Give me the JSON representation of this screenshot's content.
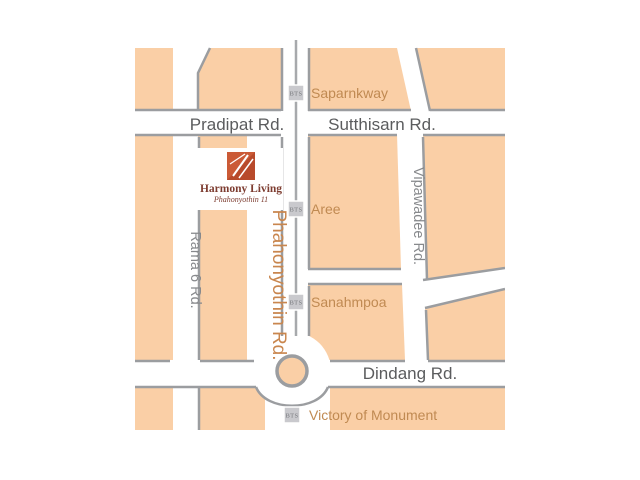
{
  "map": {
    "logo": {
      "title": "Harmony Living",
      "subtitle": "Phahonyothin 11"
    },
    "bts_label": "BTS",
    "roads": {
      "pradipat": "Pradipat Rd.",
      "sutthisarn": "Sutthisarn Rd.",
      "vipawadee": "Vipawadee Rd.",
      "rama6": "Rama 6 Rd.",
      "phahonyothin": "Phahonyothin Rd.",
      "dindang": "Dindang Rd."
    },
    "stations": {
      "saparnkway": "Saparnkway",
      "aree": "Aree",
      "sanahmpoa": "Sanahmpoa",
      "victory": "Victory of Monument"
    },
    "colors": {
      "block": "#FACFA6",
      "road": "#FFFFFF",
      "road_shadow": "#9B9DA0",
      "major_road_label": "#5B5C5E",
      "minor_road_label": "#87898C",
      "place_label": "#C08A52",
      "phahonyothin_label": "#C9864E",
      "bts_line": "#A7A9AC",
      "bts_marker_bg": "#C9C9CD",
      "bts_marker_text": "#76787C",
      "logo_red": "#CB5A36",
      "logo_text": "#7D3C30"
    }
  }
}
